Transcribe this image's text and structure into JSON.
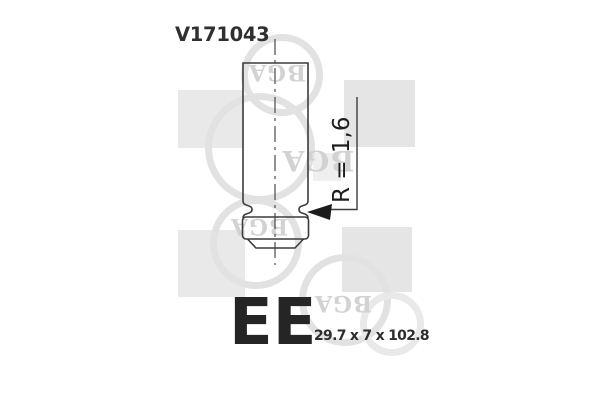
{
  "part": {
    "number": "V171043",
    "type_code": "EE",
    "dimensions": "29.7 x 7 x 102.8"
  },
  "drawing": {
    "radius_label": "R = 1,6",
    "component": "engine-valve-side-view"
  },
  "watermark": {
    "logo_text": "BGA"
  },
  "colors": {
    "background": "#ffffff",
    "drawing_line": "#3c3c3c",
    "text": "#262626",
    "watermark_square": "#e7e7e7",
    "watermark_ring": "#e2e2e2",
    "watermark_text": "#d2d2d2"
  }
}
